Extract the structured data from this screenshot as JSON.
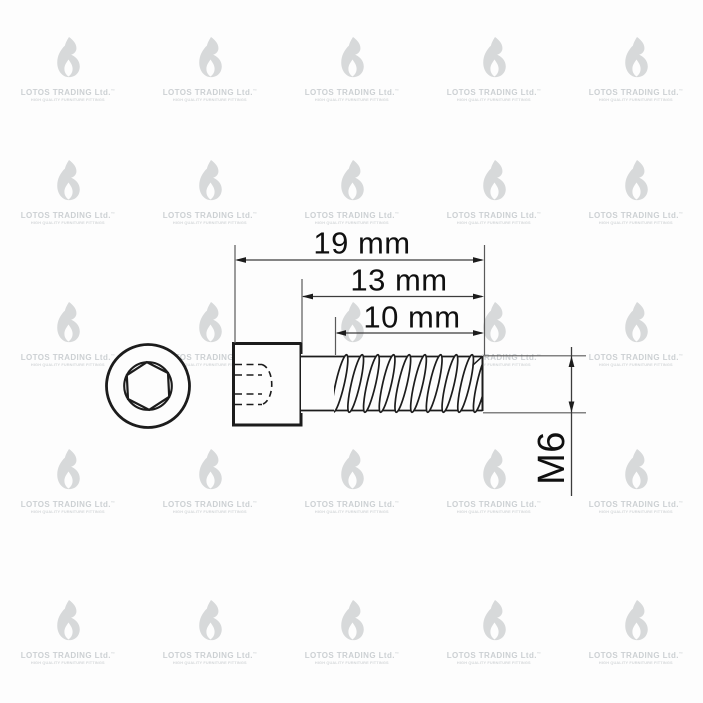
{
  "colors": {
    "background": "#fdfdfd",
    "ink": "#1c1c1c",
    "dimension_line": "#3c3c3c",
    "extension_line": "#5a5a5a",
    "watermark_logo": "#d7d9da",
    "watermark_text": "#ccd0d3",
    "watermark_tagline": "#d4d7d9"
  },
  "watermark": {
    "icon": "flame-logo",
    "brand": "LOTOS TRADING Ltd.",
    "trademark_mark": "™",
    "tagline": "HIGH QUALITY FURNITURE FITTINGS"
  },
  "drawing": {
    "dimensions": {
      "total_length": "19 mm",
      "below_head_length": "13 mm",
      "thread_length": "10 mm",
      "thread_size": "M6"
    }
  }
}
